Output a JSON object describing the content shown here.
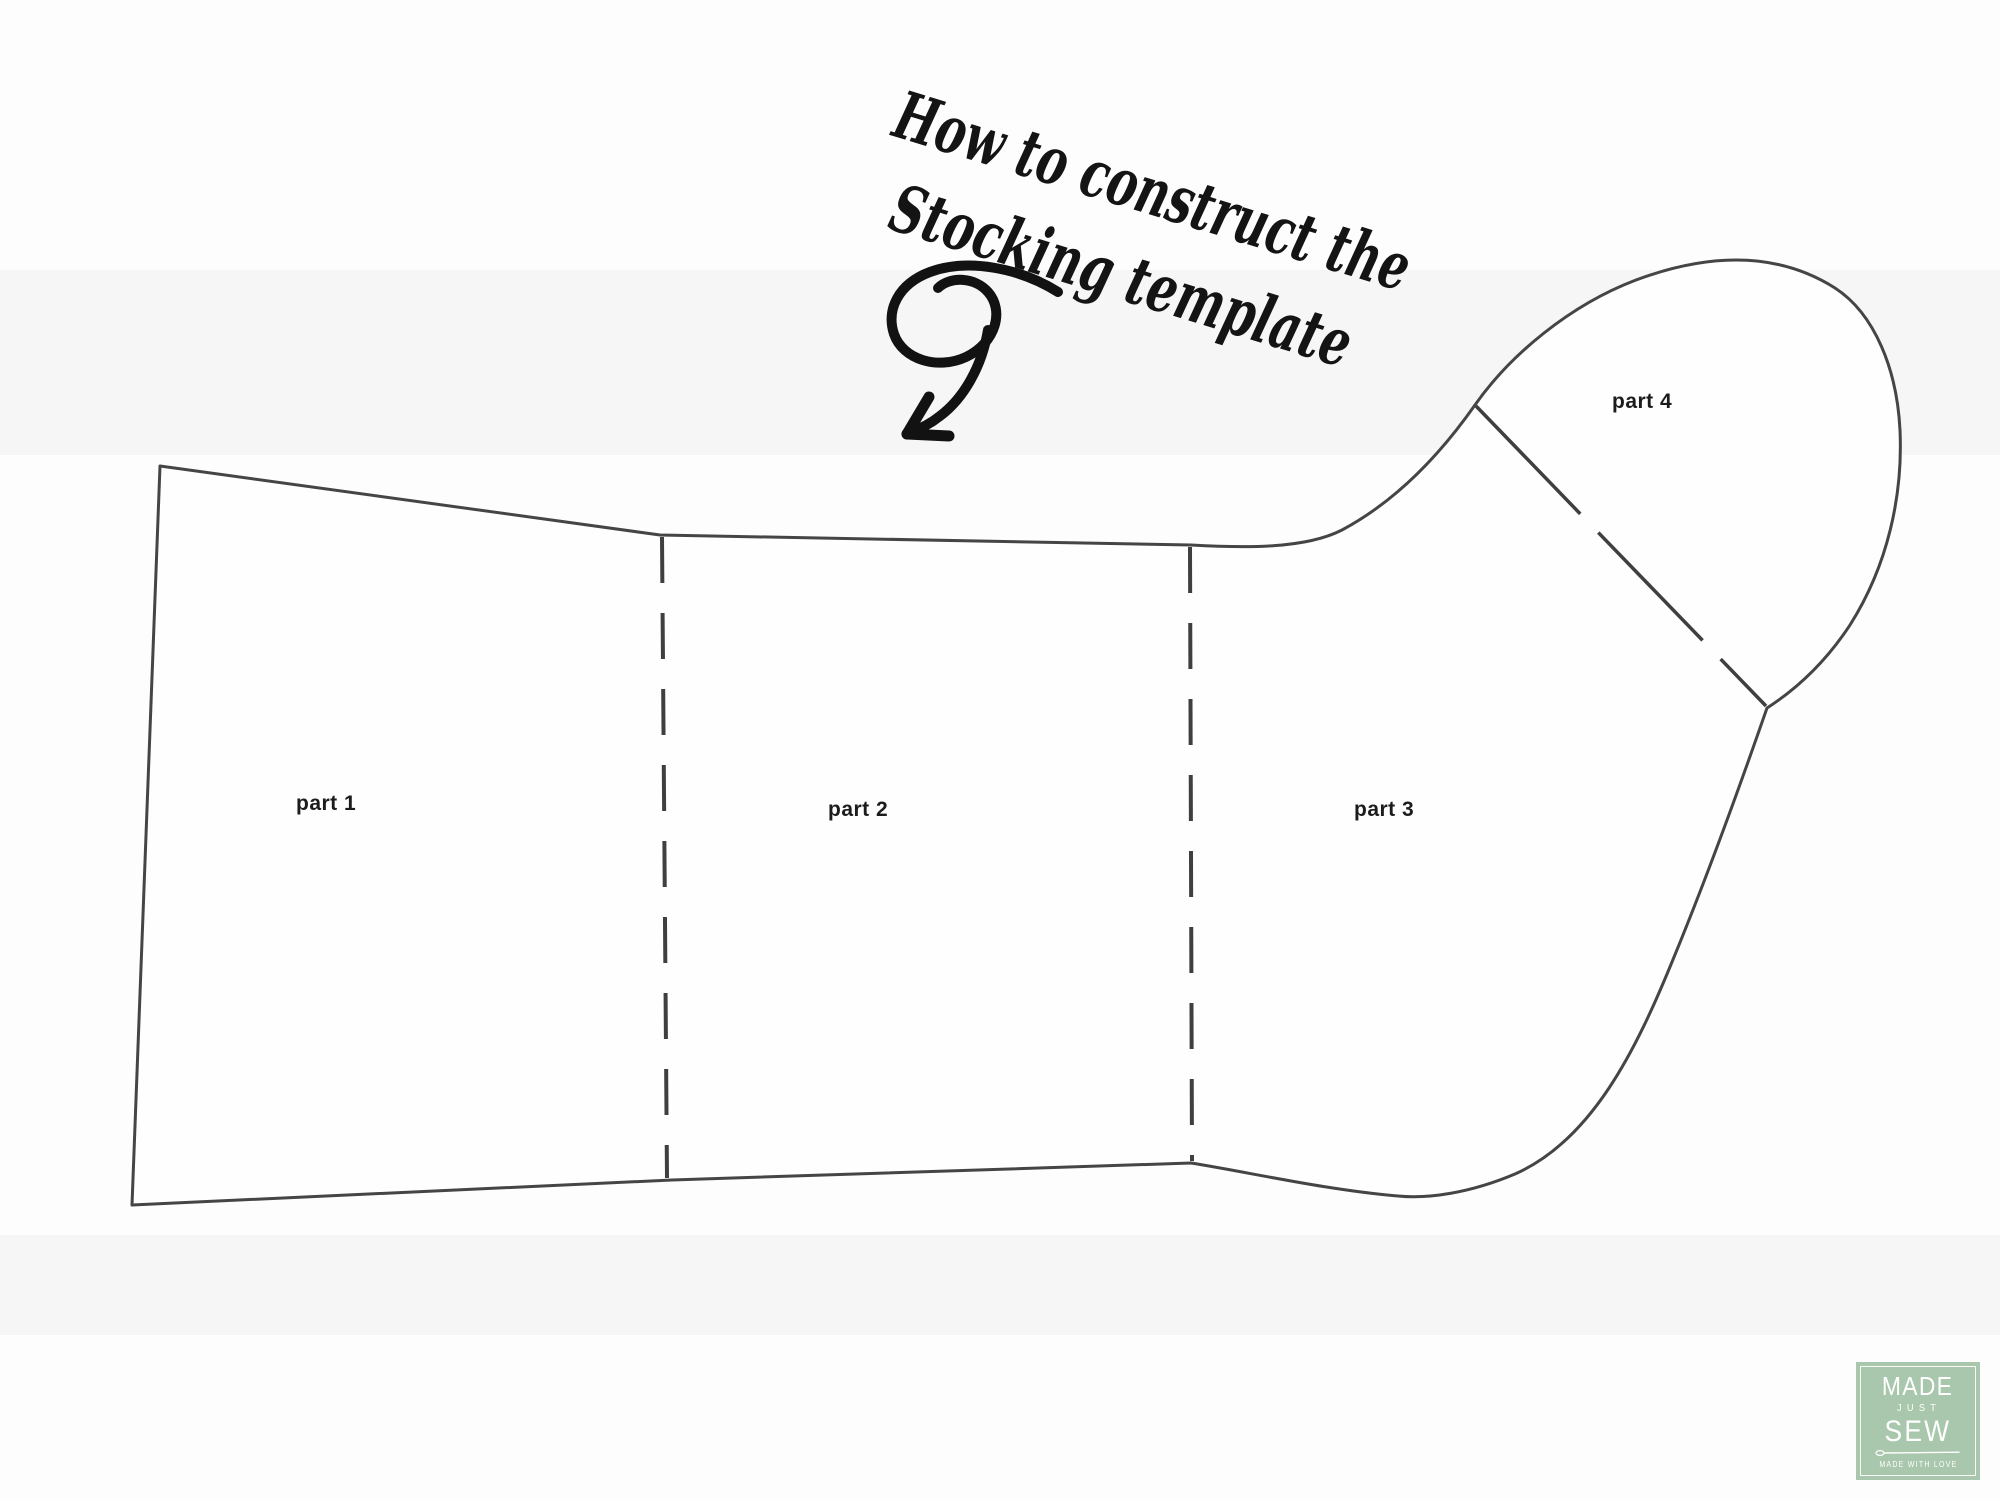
{
  "title": {
    "line1": "How to construct the",
    "line2": "Stocking template"
  },
  "pattern": {
    "labels": {
      "part1": "part 1",
      "part2": "part 2",
      "part3": "part 3",
      "part4": "part 4"
    }
  },
  "icons": {
    "swirl_arrow": "curly-arrow-pointing-down-left",
    "needle": "sewing-needle"
  },
  "colors": {
    "pattern_line": "#454545",
    "logo_background": "#a8c7ac",
    "logo_text": "#ffffff",
    "ink": "#141414"
  },
  "logo": {
    "line1": "MADE",
    "line2": "JUST",
    "line3": "SEW",
    "tagline": "MADE WITH LOVE"
  }
}
